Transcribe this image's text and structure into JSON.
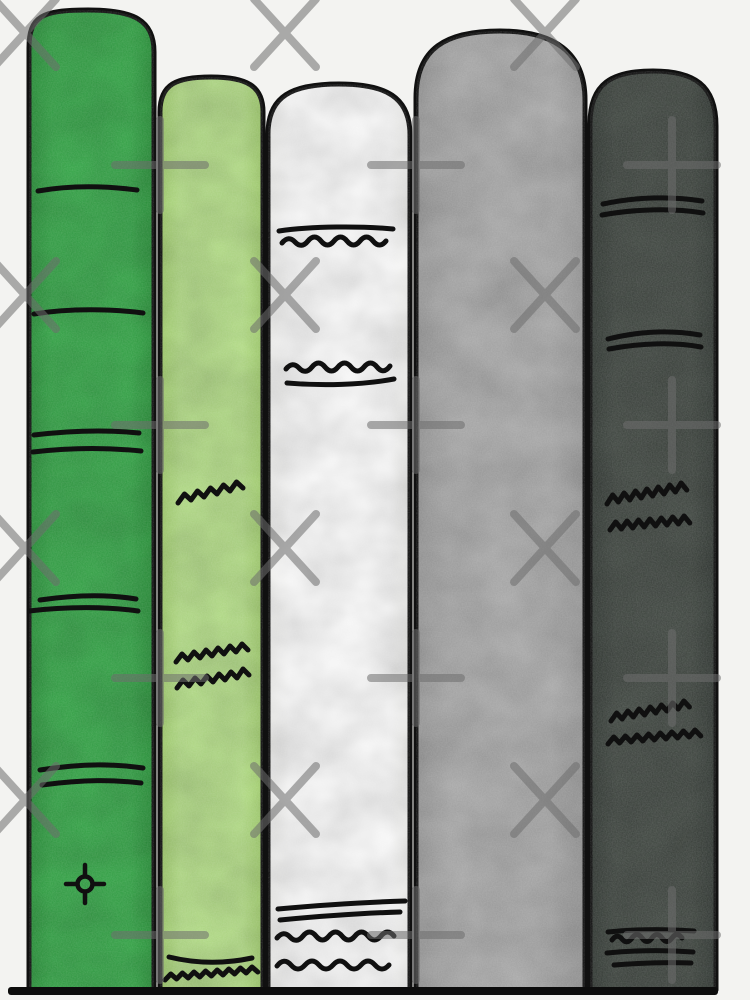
{
  "artwork": {
    "type": "watercolor illustration",
    "subject": "Five hand-drawn book spines standing upright in a row on a shelf line",
    "background_color": "#f3f3f1",
    "ink_color": "#101010",
    "shelf_line_color": "#0c0c0c",
    "books": [
      {
        "name": "tall green book",
        "fill": "#34a647",
        "edge": "#279238",
        "decorations": "single line x2, double lines x3, compass-dot emblem near base"
      },
      {
        "name": "light green book",
        "fill": "#b5df88",
        "edge": "#a3d06e",
        "decorations": "zigzag squiggle x3, curved line and tight zigzag at base"
      },
      {
        "name": "white book",
        "fill": "#ffffff",
        "edge": "#f5f5f3",
        "decorations": "line over wave at top, wave over line mid, two lines and two waves at base"
      },
      {
        "name": "light gray book",
        "fill": "#adadad",
        "edge": "#9e9e9e",
        "decorations": "plain spine"
      },
      {
        "name": "dark gray-green book",
        "fill": "#414842",
        "edge": "#333a35",
        "decorations": "double lines x2, zigzag squiggle x4, line-wave-line-line group at base"
      }
    ],
    "watermark": {
      "color": "#6e6e6e",
      "opacity": "0.55",
      "x_glyph": "X",
      "plus_glyph": "+",
      "x_cols": [
        25,
        285,
        545
      ],
      "x_rows": [
        33,
        295,
        548,
        800
      ],
      "plus_cols": [
        160,
        416,
        672
      ],
      "plus_rows": [
        165,
        425,
        678,
        935
      ]
    }
  }
}
